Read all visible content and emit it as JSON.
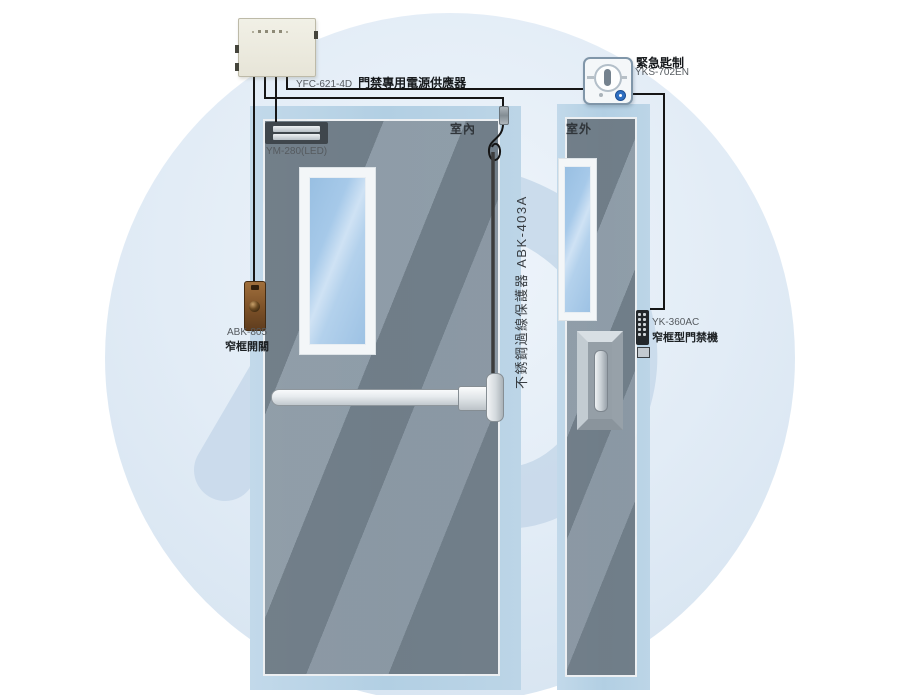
{
  "diagram": {
    "power_supply": {
      "model": "YFC-621-4D",
      "name": "門禁專用電源供應器"
    },
    "emergency_switch": {
      "name": "緊急匙制",
      "model": "YKS-702EN"
    },
    "maglock": {
      "model": "YM-280(LED)"
    },
    "exit_button": {
      "model": "ABK-805",
      "name": "窄框開關"
    },
    "cable_protector": {
      "label": "不銹鋼過線保護器 ABK-403A"
    },
    "access_keypad": {
      "model": "YK-360AC",
      "name": "窄框型門禁機"
    },
    "indoor_label": "室內",
    "outdoor_label": "室外"
  },
  "colors": {
    "frame_blue": "#b5cfe3",
    "door_gray": "#7f8992",
    "watermark_blue": "#c9daeb",
    "wire_black": "#151515",
    "button_blue": "#2e6fc2",
    "psu_beige": "#ece9db",
    "exit_button_brown": "#7c5128"
  }
}
